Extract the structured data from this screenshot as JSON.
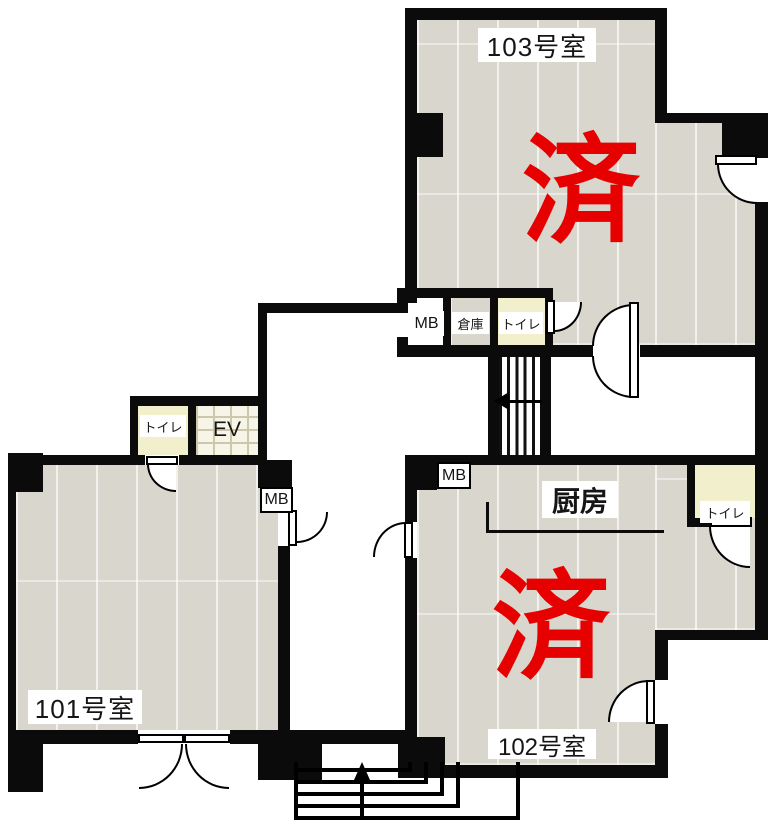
{
  "plan": {
    "rooms": {
      "r103": {
        "label": "103号室",
        "status": "済"
      },
      "r102": {
        "label": "102号室",
        "status": "済"
      },
      "r101": {
        "label": "101号室"
      },
      "kitchen": {
        "label": "厨房"
      },
      "toilet": {
        "label": "トイレ"
      },
      "storage": {
        "label": "倉庫"
      },
      "elevator": {
        "label": "EV"
      },
      "meterbox": {
        "label": "MB"
      }
    },
    "colors": {
      "wall": "#0b0b0b",
      "floor": "#d9d6cd",
      "toilet_floor": "#f2efcd",
      "elevator_floor": "#f7f4e8",
      "status_red": "#e60000"
    }
  }
}
